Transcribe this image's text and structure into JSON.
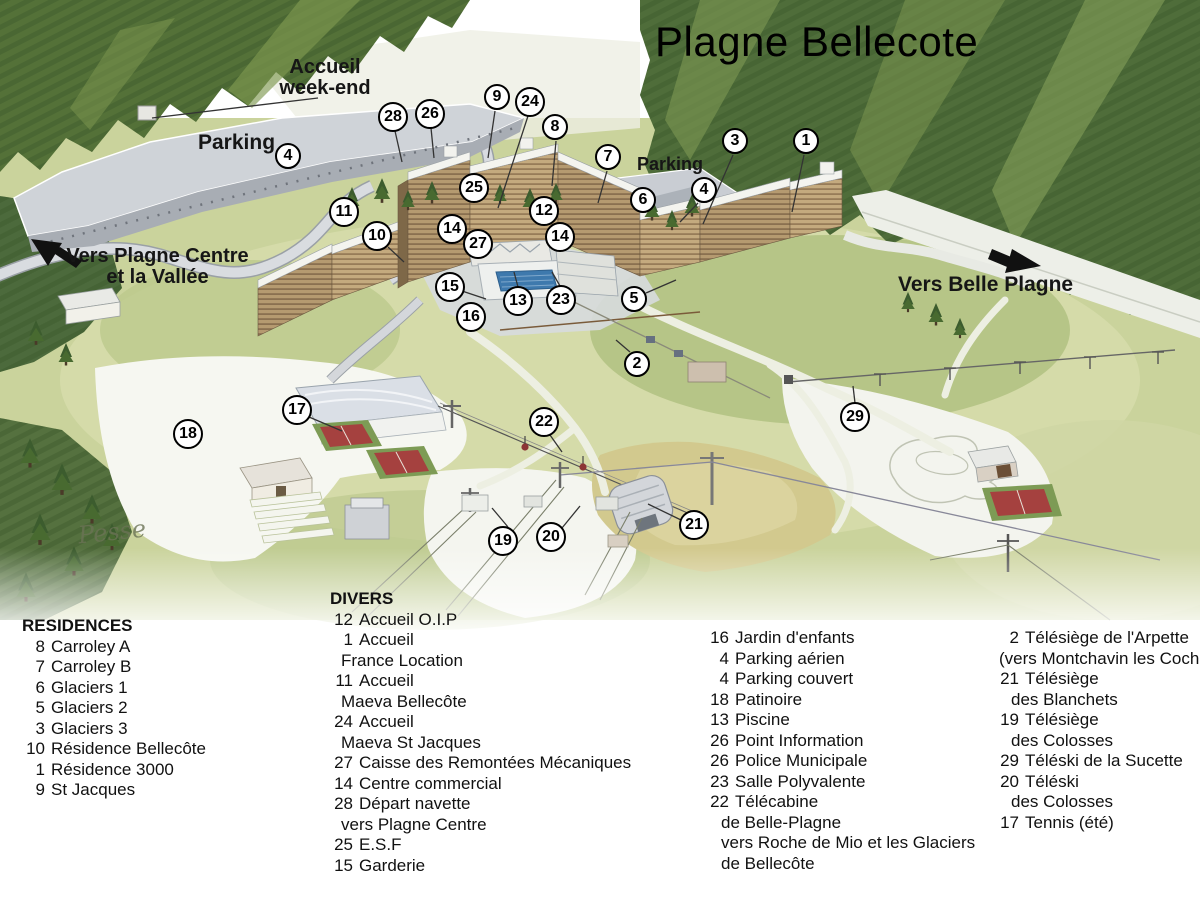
{
  "title": "Plagne Bellecote",
  "map_labels": {
    "accueil_line1": "Accueil",
    "accueil_line2": "week-end",
    "parking_left": "Parking",
    "parking_right": "Parking",
    "vers_plagne_line1": "Vers Plagne Centre",
    "vers_plagne_line2": "et la Vallée",
    "vers_belle_plagne": "Vers Belle Plagne",
    "signature": "Pesse"
  },
  "icons": {
    "arrow_left": "direction-arrow-to-plagne-centre",
    "arrow_right": "direction-arrow-to-belle-plagne"
  },
  "markers": [
    {
      "n": "9",
      "x": 497,
      "y": 97
    },
    {
      "n": "24",
      "x": 530,
      "y": 102
    },
    {
      "n": "28",
      "x": 393,
      "y": 117
    },
    {
      "n": "26",
      "x": 430,
      "y": 114
    },
    {
      "n": "8",
      "x": 555,
      "y": 127
    },
    {
      "n": "7",
      "x": 608,
      "y": 157
    },
    {
      "n": "3",
      "x": 735,
      "y": 141
    },
    {
      "n": "1",
      "x": 806,
      "y": 141
    },
    {
      "n": "4",
      "x": 288,
      "y": 156
    },
    {
      "n": "4",
      "x": 704,
      "y": 190
    },
    {
      "n": "25",
      "x": 474,
      "y": 188
    },
    {
      "n": "6",
      "x": 643,
      "y": 200
    },
    {
      "n": "11",
      "x": 344,
      "y": 212
    },
    {
      "n": "12",
      "x": 544,
      "y": 211
    },
    {
      "n": "14",
      "x": 452,
      "y": 229
    },
    {
      "n": "14",
      "x": 560,
      "y": 237
    },
    {
      "n": "10",
      "x": 377,
      "y": 236
    },
    {
      "n": "27",
      "x": 478,
      "y": 244
    },
    {
      "n": "15",
      "x": 450,
      "y": 287
    },
    {
      "n": "13",
      "x": 518,
      "y": 301
    },
    {
      "n": "23",
      "x": 561,
      "y": 300
    },
    {
      "n": "5",
      "x": 634,
      "y": 299
    },
    {
      "n": "16",
      "x": 471,
      "y": 317
    },
    {
      "n": "2",
      "x": 637,
      "y": 364
    },
    {
      "n": "17",
      "x": 297,
      "y": 410
    },
    {
      "n": "18",
      "x": 188,
      "y": 434
    },
    {
      "n": "22",
      "x": 544,
      "y": 422
    },
    {
      "n": "29",
      "x": 855,
      "y": 417
    },
    {
      "n": "19",
      "x": 503,
      "y": 541
    },
    {
      "n": "20",
      "x": 551,
      "y": 537
    },
    {
      "n": "21",
      "x": 694,
      "y": 525
    }
  ],
  "legend": {
    "residences": {
      "heading": "RESIDENCES",
      "items": [
        {
          "num": "8",
          "label": "Carroley A"
        },
        {
          "num": "7",
          "label": "Carroley B"
        },
        {
          "num": "6",
          "label": "Glaciers 1"
        },
        {
          "num": "5",
          "label": "Glaciers 2"
        },
        {
          "num": "3",
          "label": "Glaciers 3"
        },
        {
          "num": "10",
          "label": "Résidence Bellecôte"
        },
        {
          "num": "1",
          "label": "Résidence 3000"
        },
        {
          "num": "9",
          "label": "St Jacques"
        }
      ]
    },
    "divers": {
      "heading": "DIVERS",
      "items": [
        {
          "num": "12",
          "label": "Accueil O.I.P"
        },
        {
          "num": "1",
          "label": "Accueil"
        },
        {
          "num": "",
          "label": "France Location",
          "shift": -18
        },
        {
          "num": "11",
          "label": "Accueil"
        },
        {
          "num": "",
          "label": "Maeva Bellecôte",
          "shift": -18
        },
        {
          "num": "24",
          "label": "Accueil"
        },
        {
          "num": "",
          "label": "Maeva St Jacques",
          "shift": -18
        },
        {
          "num": "27",
          "label": "Caisse des Remontées Mécaniques"
        },
        {
          "num": "14",
          "label": "Centre commercial"
        },
        {
          "num": "28",
          "label": "Départ navette"
        },
        {
          "num": "",
          "label": "vers Plagne Centre",
          "shift": -18
        },
        {
          "num": "25",
          "label": "E.S.F"
        },
        {
          "num": "15",
          "label": "Garderie"
        }
      ]
    },
    "services": {
      "items": [
        {
          "num": "16",
          "label": "Jardin d'enfants"
        },
        {
          "num": "4",
          "label": "Parking aérien"
        },
        {
          "num": "4",
          "label": "Parking couvert"
        },
        {
          "num": "18",
          "label": "Patinoire"
        },
        {
          "num": "13",
          "label": "Piscine"
        },
        {
          "num": "26",
          "label": "Point Information"
        },
        {
          "num": "26",
          "label": "Police Municipale"
        },
        {
          "num": "23",
          "label": "Salle Polyvalente"
        },
        {
          "num": "22",
          "label": "Télécabine"
        },
        {
          "num": "",
          "label": "de Belle-Plagne",
          "shift": -14
        },
        {
          "num": "",
          "label": "vers Roche de Mio et les Glaciers",
          "shift": -14
        },
        {
          "num": "",
          "label": "de Bellecôte",
          "shift": -14
        }
      ]
    },
    "lifts": {
      "items": [
        {
          "num": "2",
          "label": "Télésiège de l'Arpette"
        },
        {
          "num": "",
          "label": "(vers Montchavin les Coch",
          "shift": -26
        },
        {
          "num": "21",
          "label": "Télésiège"
        },
        {
          "num": "",
          "label": "des Blanchets",
          "shift": -14
        },
        {
          "num": "19",
          "label": "Télésiège"
        },
        {
          "num": "",
          "label": "des Colosses",
          "shift": -14
        },
        {
          "num": "29",
          "label": "Téléski de la Sucette"
        },
        {
          "num": "20",
          "label": "Téléski"
        },
        {
          "num": "",
          "label": "des Colosses",
          "shift": -14
        },
        {
          "num": "17",
          "label": "Tennis (été)"
        }
      ]
    }
  },
  "palette": {
    "forest_dark": "#4c6a36",
    "hill_light": "#cad39c",
    "road_gray": "#cfd3d8",
    "pool_blue": "#3e79ad",
    "tennis_red": "#a5413f",
    "marker_border": "#000000",
    "gondola_red": "#8c3434"
  }
}
